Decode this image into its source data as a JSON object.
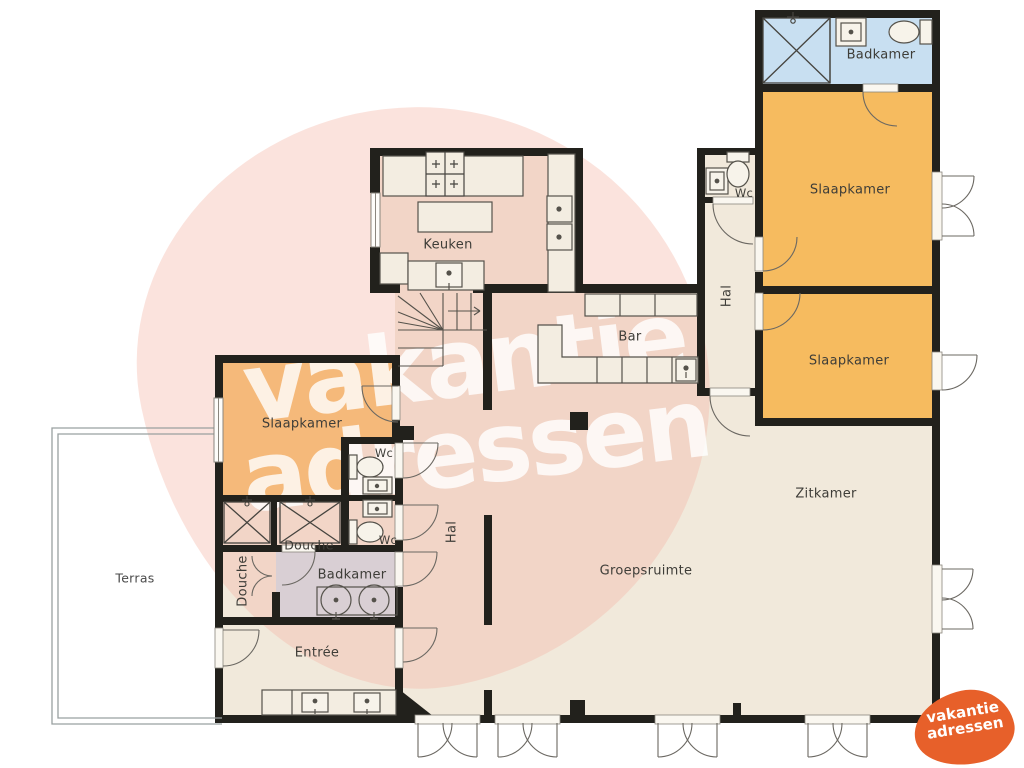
{
  "watermark": {
    "line1": "vakantie",
    "line2": "adressen"
  },
  "logo": {
    "line1": "vakantie",
    "line2": "adressen"
  },
  "colors": {
    "wall": "#22211C",
    "floor": "#F1E9DB",
    "bedroom_orange": "#F6BB5F",
    "bathroom_blue": "#C8DFF1",
    "watermark_pink": "#F4B5A6",
    "logo_orange": "#E7602A"
  },
  "labels": {
    "badkamer_top": "Badkamer",
    "slaapkamer_ne": "Slaapkamer",
    "slaapkamer_e": "Slaapkamer",
    "slaapkamer_w": "Slaapkamer",
    "wc_top": "Wc",
    "wc_mid": "Wc",
    "wc_low": "Wc",
    "hal_right": "Hal",
    "hal_center": "Hal",
    "keuken": "Keuken",
    "bar": "Bar",
    "zitkamer": "Zitkamer",
    "groepsruimte": "Groepsruimte",
    "douche_stall": "Douche",
    "douche_room": "Douche",
    "badkamer_left": "Badkamer",
    "entree": "Entrée",
    "terras": "Terras"
  }
}
